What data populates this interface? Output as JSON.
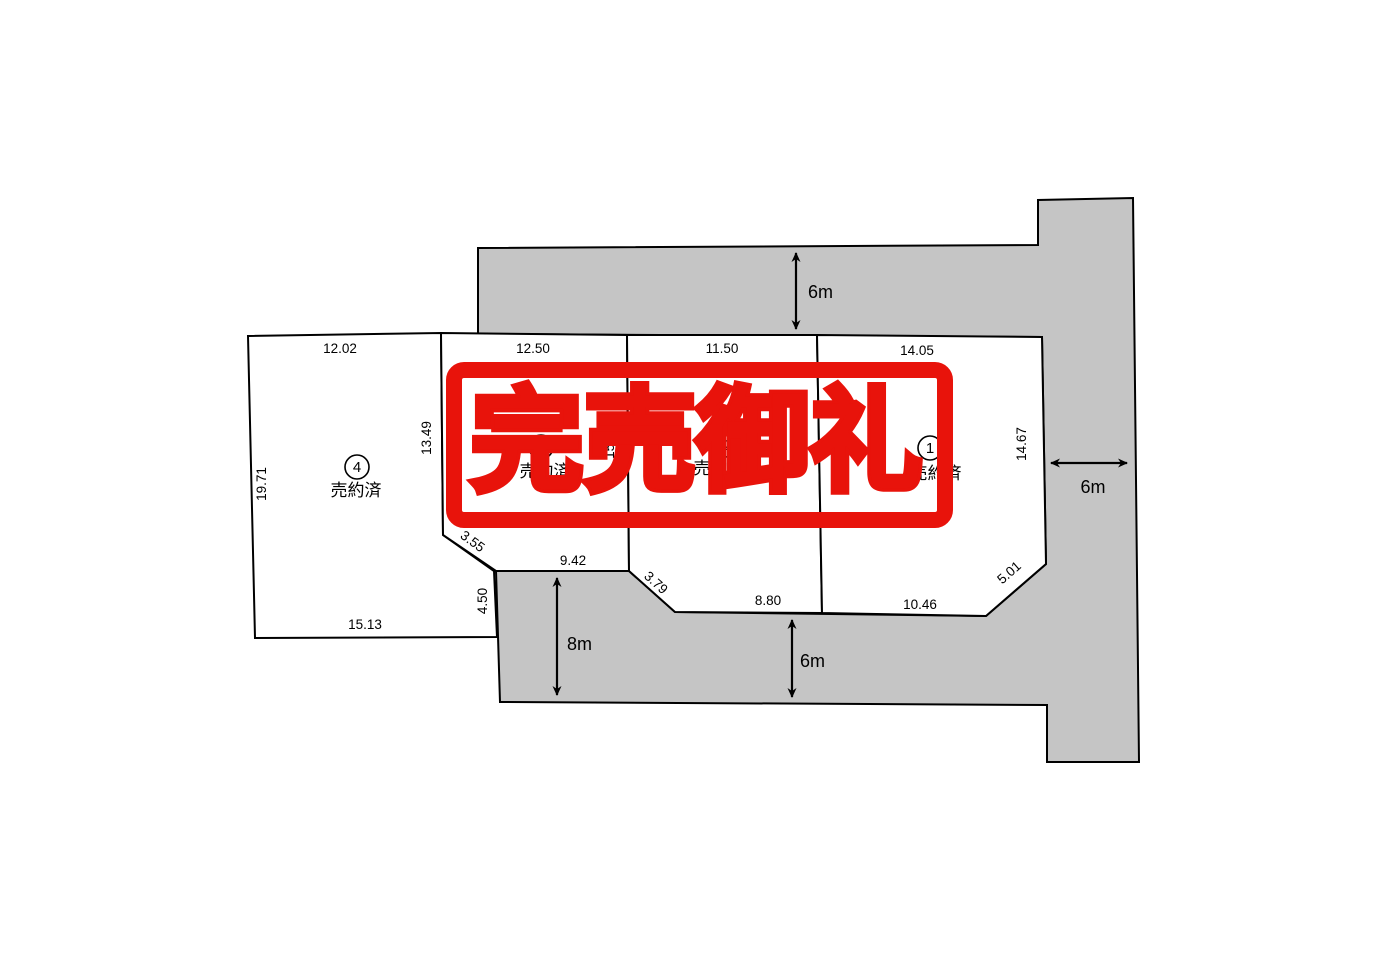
{
  "colors": {
    "background": "#ffffff",
    "road_fill": "#c5c5c5",
    "lot_fill": "#ffffff",
    "line": "#000000",
    "stamp_red": "#e8130b"
  },
  "stamp": {
    "text": "完売御礼"
  },
  "roads": {
    "top": {
      "width_label": "6m"
    },
    "right": {
      "width_label": "6m"
    },
    "bottom_east": {
      "width_label": "6m"
    },
    "bottom_west": {
      "width_label": "8m"
    }
  },
  "lots": [
    {
      "number": "1",
      "number_circled": "①",
      "status": "売約済",
      "dims": {
        "top": "14.05",
        "east": "14.67",
        "bottom": "10.46",
        "corner_se": "5.01"
      }
    },
    {
      "number": "2",
      "number_circled": "②",
      "status": "売約済",
      "dims": {
        "top": "11.50",
        "east": "18.10",
        "bottom": "8.80",
        "corner_sw": "3.79"
      }
    },
    {
      "number": "3",
      "number_circled": "③",
      "status": "売約済",
      "dims": {
        "top": "12.50",
        "east": "15.16",
        "bottom": "9.42"
      }
    },
    {
      "number": "4",
      "number_circled": "④",
      "status": "売約済",
      "dims": {
        "top": "12.02",
        "west": "19.71",
        "east": "13.49",
        "bottom": "15.13",
        "corner_se": "3.55",
        "east_lower": "4.50"
      }
    }
  ]
}
